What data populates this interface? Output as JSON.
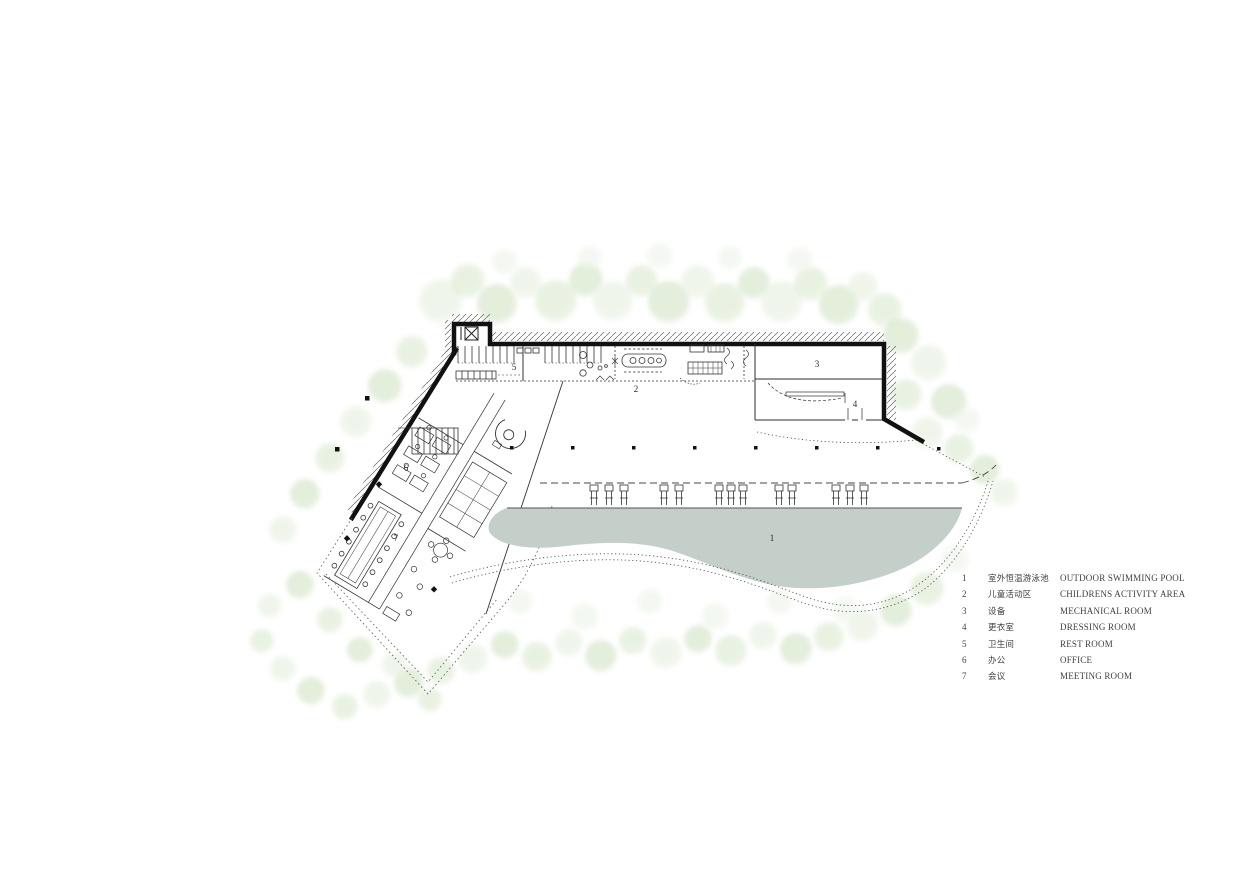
{
  "legend": {
    "rows": [
      {
        "num": "1",
        "zh": "室外恒温游泳池",
        "en": "OUTDOOR SWIMMING POOL"
      },
      {
        "num": "2",
        "zh": "儿童活动区",
        "en": "CHILDRENS ACTIVITY AREA"
      },
      {
        "num": "3",
        "zh": "设备",
        "en": "MECHANICAL ROOM"
      },
      {
        "num": "4",
        "zh": "更衣室",
        "en": "DRESSING ROOM"
      },
      {
        "num": "5",
        "zh": "卫生间",
        "en": "REST ROOM"
      },
      {
        "num": "6",
        "zh": "办公",
        "en": "OFFICE"
      },
      {
        "num": "7",
        "zh": "会议",
        "en": "MEETING ROOM"
      }
    ]
  },
  "plan": {
    "pool_color": "#c4cfc9",
    "wall_color": "#111111",
    "room_markers": [
      {
        "num": "1",
        "x": 772,
        "y": 541,
        "name": "outdoor-swimming-pool-label"
      },
      {
        "num": "2",
        "x": 636,
        "y": 392,
        "name": "childrens-activity-area-label"
      },
      {
        "num": "3",
        "x": 817,
        "y": 367,
        "name": "mechanical-room-label"
      },
      {
        "num": "4",
        "x": 855,
        "y": 407,
        "name": "dressing-room-label"
      },
      {
        "num": "5",
        "x": 514,
        "y": 370,
        "name": "rest-room-label"
      },
      {
        "num": "6",
        "x": 406,
        "y": 471,
        "name": "office-label"
      },
      {
        "num": "7",
        "x": 396,
        "y": 541,
        "name": "meeting-room-label"
      }
    ]
  },
  "site": {
    "tree_palette": [
      "#e7f0e0",
      "#dcead0",
      "#d2e3c4",
      "#eef4ea",
      "#cdddbf"
    ],
    "deck_chairs": [
      590,
      605,
      620,
      660,
      675,
      715,
      727,
      739,
      775,
      788,
      832,
      846,
      860
    ],
    "trees": [
      [
        441,
        301,
        22,
        0
      ],
      [
        468,
        281,
        17,
        1
      ],
      [
        497,
        304,
        20,
        2
      ],
      [
        526,
        283,
        16,
        0
      ],
      [
        556,
        301,
        21,
        1
      ],
      [
        586,
        280,
        17,
        2
      ],
      [
        613,
        301,
        20,
        0
      ],
      [
        642,
        281,
        16,
        1
      ],
      [
        669,
        302,
        21,
        2
      ],
      [
        698,
        282,
        17,
        0
      ],
      [
        725,
        303,
        20,
        1
      ],
      [
        754,
        283,
        16,
        2
      ],
      [
        782,
        302,
        21,
        0
      ],
      [
        811,
        284,
        17,
        1
      ],
      [
        839,
        305,
        20,
        2
      ],
      [
        863,
        287,
        15,
        0
      ],
      [
        885,
        310,
        17,
        1
      ],
      [
        505,
        262,
        13,
        3
      ],
      [
        590,
        258,
        12,
        3
      ],
      [
        660,
        256,
        13,
        3
      ],
      [
        730,
        258,
        12,
        3
      ],
      [
        800,
        260,
        13,
        3
      ],
      [
        412,
        352,
        16,
        1
      ],
      [
        385,
        386,
        17,
        2
      ],
      [
        356,
        422,
        16,
        0
      ],
      [
        330,
        458,
        15,
        1
      ],
      [
        305,
        494,
        15,
        2
      ],
      [
        283,
        530,
        14,
        0
      ],
      [
        901,
        336,
        18,
        2
      ],
      [
        929,
        363,
        18,
        0
      ],
      [
        906,
        395,
        16,
        1
      ],
      [
        949,
        402,
        18,
        2
      ],
      [
        927,
        433,
        16,
        0
      ],
      [
        959,
        449,
        15,
        1
      ],
      [
        985,
        470,
        15,
        2
      ],
      [
        1004,
        493,
        14,
        0
      ],
      [
        967,
        420,
        13,
        3
      ],
      [
        927,
        589,
        17,
        1
      ],
      [
        896,
        611,
        16,
        2
      ],
      [
        863,
        626,
        16,
        0
      ],
      [
        829,
        637,
        15,
        1
      ],
      [
        796,
        649,
        16,
        2
      ],
      [
        763,
        636,
        14,
        0
      ],
      [
        731,
        651,
        16,
        1
      ],
      [
        698,
        639,
        14,
        2
      ],
      [
        666,
        653,
        16,
        0
      ],
      [
        633,
        641,
        14,
        1
      ],
      [
        601,
        656,
        16,
        2
      ],
      [
        569,
        643,
        14,
        0
      ],
      [
        537,
        657,
        15,
        1
      ],
      [
        505,
        645,
        14,
        2
      ],
      [
        473,
        659,
        15,
        0
      ],
      [
        441,
        671,
        14,
        1
      ],
      [
        409,
        683,
        15,
        2
      ],
      [
        377,
        695,
        14,
        0
      ],
      [
        345,
        707,
        13,
        1
      ],
      [
        311,
        691,
        14,
        2
      ],
      [
        283,
        669,
        13,
        0
      ],
      [
        262,
        641,
        12,
        1
      ],
      [
        955,
        560,
        14,
        3
      ],
      [
        520,
        602,
        13,
        3
      ],
      [
        585,
        617,
        14,
        3
      ],
      [
        650,
        602,
        13,
        3
      ],
      [
        715,
        617,
        14,
        3
      ],
      [
        780,
        602,
        13,
        3
      ],
      [
        845,
        610,
        13,
        3
      ],
      [
        300,
        585,
        14,
        2
      ],
      [
        270,
        606,
        12,
        0
      ],
      [
        330,
        620,
        13,
        1
      ],
      [
        360,
        650,
        13,
        2
      ],
      [
        395,
        665,
        13,
        0
      ],
      [
        430,
        700,
        12,
        1
      ]
    ]
  }
}
